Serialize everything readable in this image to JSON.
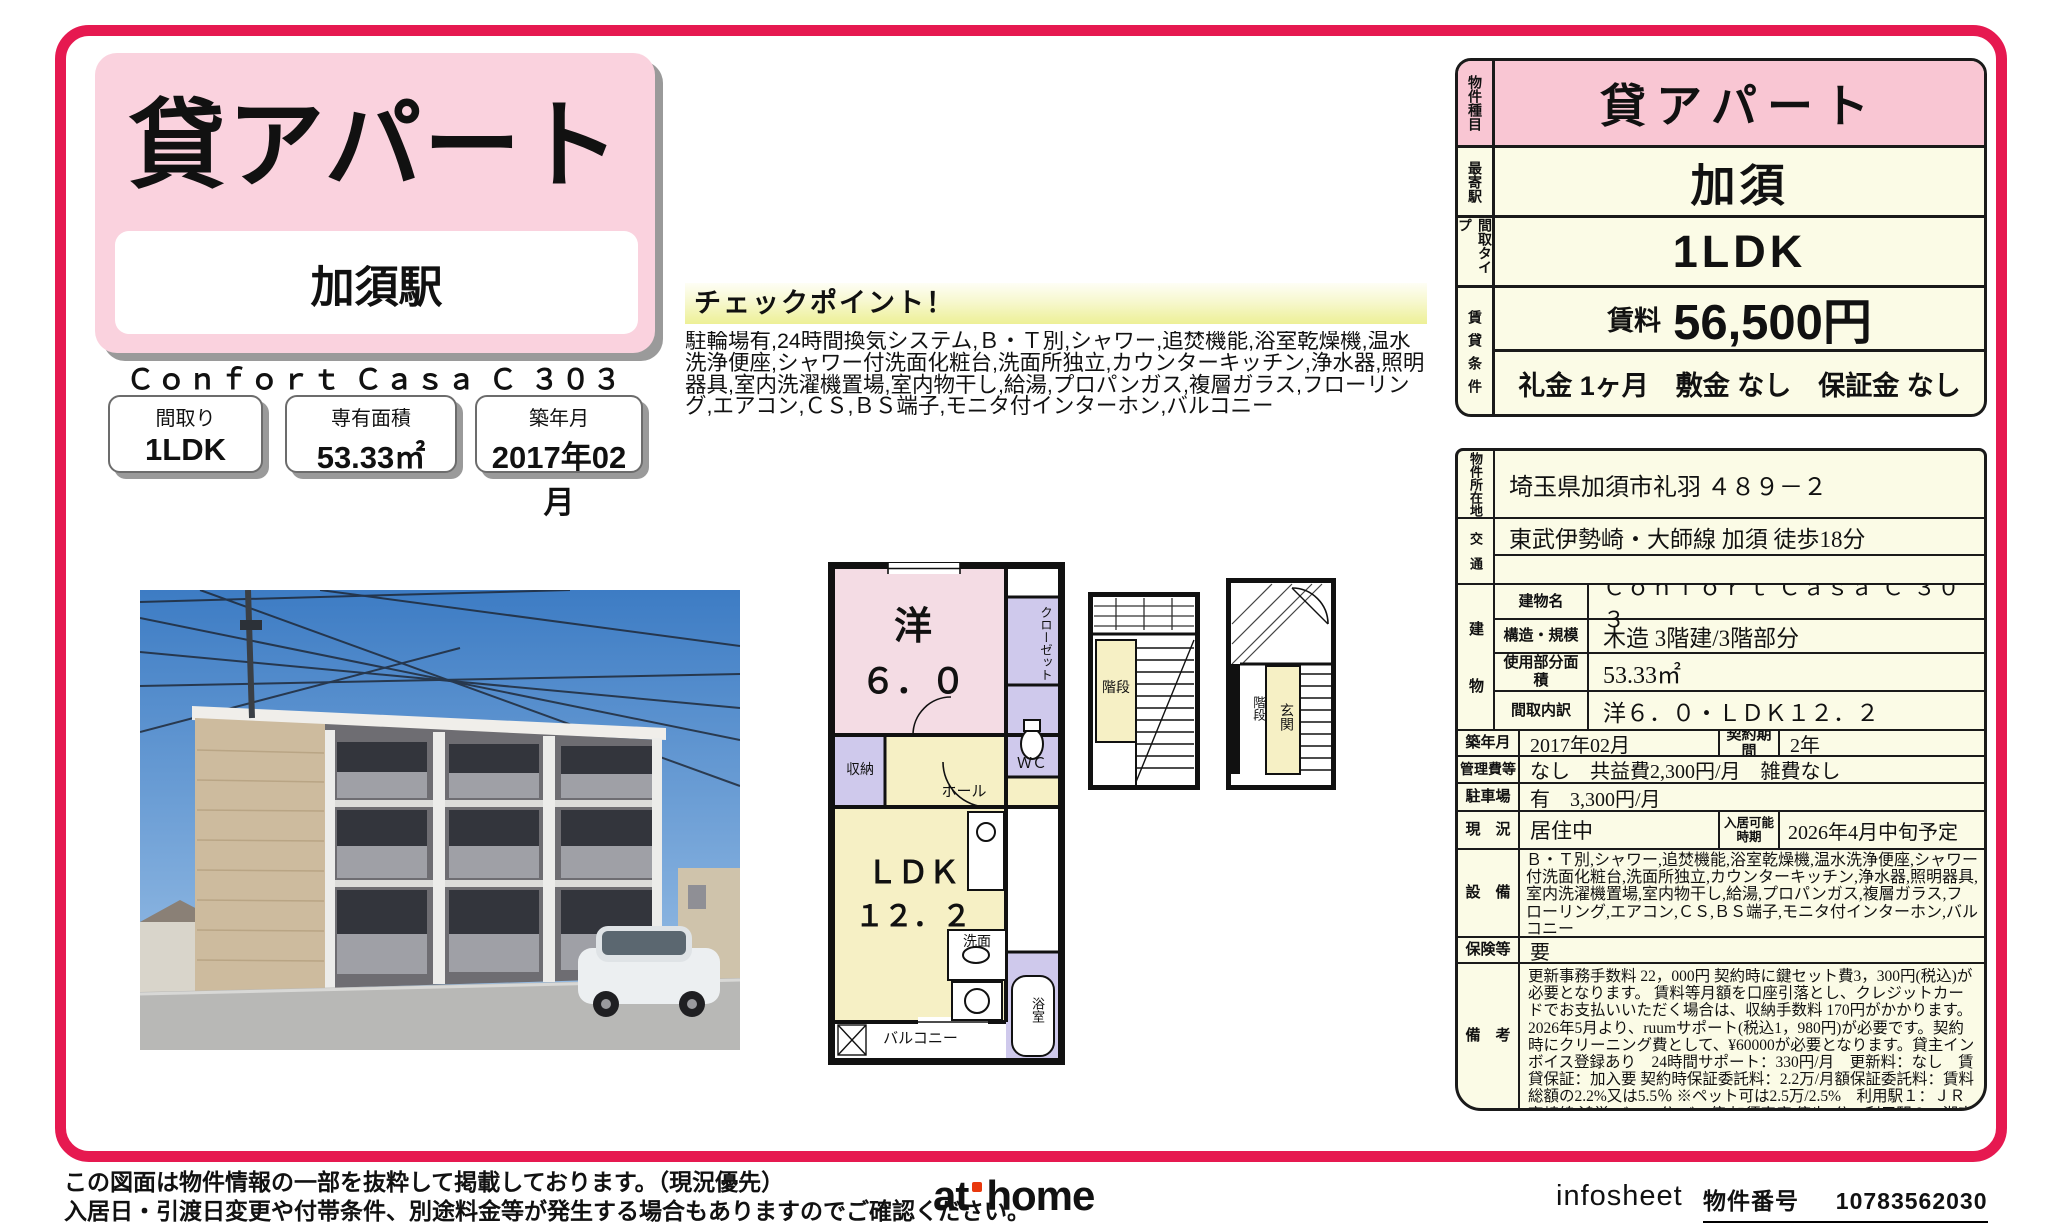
{
  "header": {
    "property_type": "貸アパート",
    "station": "加須駅",
    "building_name": "Ｃｏｎｆｏｒｔ Ｃａｓａ Ｃ ３０３"
  },
  "summary_boxes": [
    {
      "label": "間取り",
      "value": "1LDK"
    },
    {
      "label": "専有面積",
      "value": "53.33㎡"
    },
    {
      "label": "築年月",
      "value": "2017年02月"
    }
  ],
  "checkpoint": {
    "title": "チェックポイント！",
    "text": "駐輪場有,24時間換気システム,Ｂ・Ｔ別,シャワー,追焚機能,浴室乾燥機,温水洗浄便座,シャワー付洗面化粧台,洗面所独立,カウンターキッチン,浄水器,照明器具,室内洗濯機置場,室内物干し,給湯,プロパンガス,複層ガラス,フローリング,エアコン,ＣＳ,ＢＳ端子,モニタ付インターホン,バルコニー"
  },
  "floorplan": {
    "western_room": "洋",
    "western_size": "６．０",
    "closet": "クローゼット",
    "wc": "ＷＣ",
    "storage": "収納",
    "hall": "ホール",
    "ldk": "ＬＤＫ",
    "ldk_size": "１２．２",
    "washroom": "洗面",
    "bath": "浴室",
    "balcony": "バルコニー",
    "stairs1": "階段",
    "stairs2": "階段",
    "entrance": "玄関"
  },
  "price_table": {
    "type_label": "物件種目",
    "type_value": "貸アパート",
    "station_label": "最寄駅",
    "station_value": "加須",
    "layout_label": "間取タイプ",
    "layout_value": "1LDK",
    "terms_label": "賃貸条件",
    "rent_label": "賃料",
    "rent_value": "56,500円",
    "terms_value": "礼金 1ヶ月　敷金 なし　保証金 なし"
  },
  "detail_table": {
    "address_label": "物件所在地",
    "address_value": "埼玉県加須市礼羽 ４８９－２",
    "transport_label": "交通",
    "transport_value": "東武伊勢崎・大師線 加須 徒歩18分",
    "building_label": "建物",
    "building_name_label": "建物名",
    "building_name_value": "Ｃｏｎｆｏｒｔ Ｃａｓａ Ｃ ３０３",
    "structure_label": "構造・規模",
    "structure_value": "木造 3階建/3階部分",
    "area_label": "使用部分面積",
    "area_value": "53.33㎡",
    "layout_detail_label": "間取内訳",
    "layout_detail_value": "洋６．０・ＬＤＫ１２．２",
    "built_label": "築年月",
    "built_value": "2017年02月",
    "contract_label": "契約期間",
    "contract_value": "2年",
    "fees_label": "管理費等",
    "fees_value": "なし　共益費2,300円/月　雑費なし",
    "parking_label": "駐車場",
    "parking_value": "有　3,300円/月",
    "status_label": "現　況",
    "status_value": "居住中",
    "movein_label": "入居可能時期",
    "movein_value": "2026年4月中旬予定",
    "equipment_label": "設　備",
    "equipment_value": "Ｂ・Ｔ別,シャワー,追焚機能,浴室乾燥機,温水洗浄便座,シャワー付洗面化粧台,洗面所独立,カウンターキッチン,浄水器,照明器具,室内洗濯機置場,室内物干し,給湯,プロパンガス,複層ガラス,フローリング,エアコン,ＣＳ,ＢＳ端子,モニタ付インターホン,バルコニー",
    "insurance_label": "保険等",
    "insurance_value": "要",
    "notes_label": "備　考",
    "notes_value": "更新事務手数料 22，000円 契約時に鍵セット費3，300円(税込)が必要となります。 賃料等月額を口座引落とし、クレジットカードでお支払いいただく場合は、収納手数料 170円がかかります。2026年5月より、ruumサポート(税込1，980円)が必要です。契約時にクリーニング費として、¥60000が必要となります。貸主インボイス登録あり　24時間サポート：330円/月　更新料：なし　賃貸保証：加入要 契約時保証委託料：2.2万/月額保証委託料：賃料総額の2.2%又は5.5％ ※ペット可は2.5万/2.5%　利用駅１：ＪＲ高崎線 鴻巣 バス45分 バス停 加須車庫 停歩9分　利用駅２：湘南新宿ライン（前橋～小田原） 鴻巣 バス45分 バス停 加須車庫 停歩9分"
  },
  "footer": {
    "disclaimer_line1": "この図面は物件情報の一部を抜粋して掲載しております。（現況優先）",
    "disclaimer_line2": "入居日・引渡日変更や付帯条件、別途料金等が発生する場合もありますのでご確認ください。",
    "logo_left": "at",
    "logo_right": "home",
    "infosheet_label": "infosheet",
    "property_number_label": "物件番号",
    "property_number": "10783562030"
  },
  "colors": {
    "frame_red": "#e61950",
    "header_pink": "#fad2de",
    "table_pink": "#f9c6d3",
    "cream": "#fbfbe6",
    "plan_pink": "#f4dce4",
    "plan_lavender": "#cfc9ec",
    "plan_cream": "#f6f0c5"
  }
}
